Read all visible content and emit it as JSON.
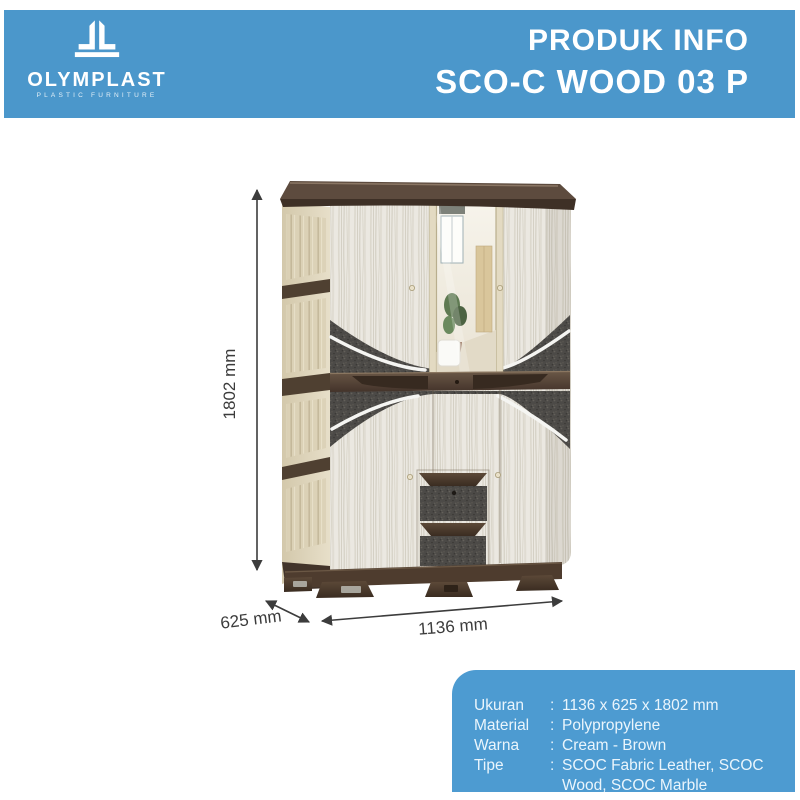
{
  "header": {
    "brand": "OLYMPLAST",
    "tagline": "PLASTIC FURNITURE",
    "title_line1": "PRODUK INFO",
    "title_line2": "SCO-C WOOD 03 P"
  },
  "icons": {
    "logo": "olymplast-building-pillars"
  },
  "dimensions": {
    "height": "1802 mm",
    "depth": "625 mm",
    "width": "1136 mm"
  },
  "specs": {
    "rows": [
      {
        "label": "Ukuran",
        "separator": ":",
        "value": "1136 x 625 x 1802 mm"
      },
      {
        "label": "Material",
        "separator": ":",
        "value": "Polypropylene"
      },
      {
        "label": "Warna",
        "separator": ":",
        "value": "Cream - Brown"
      },
      {
        "label": "Tipe",
        "separator": ":",
        "value": "SCOC Fabric Leather, SCOC Wood, SCOC Marble"
      }
    ]
  },
  "colors": {
    "header_blue": "#4b97cb",
    "panel_blue": "#4d9bd1",
    "dim_line": "#3c3c3c",
    "cream": "#dbd1b6",
    "brown": "#4e3c2e",
    "fabric_gray": "#4c4a47"
  }
}
